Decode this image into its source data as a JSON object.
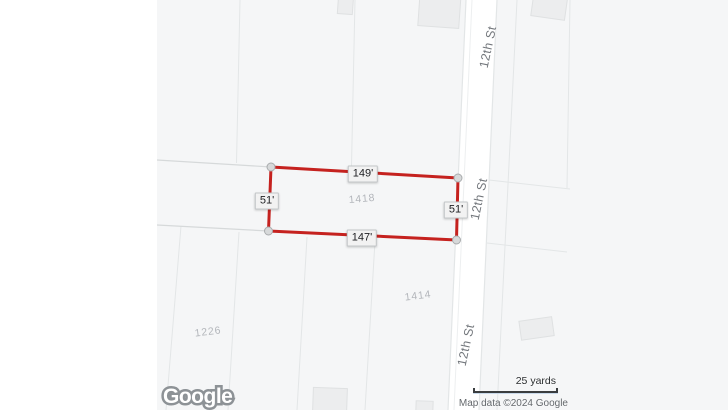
{
  "colors": {
    "land": "#f5f6f7",
    "road": "#ffffff",
    "line": "#e3e6e7",
    "boundary": "#d6d9da",
    "building": "#ecedee",
    "building_edge": "#dfe1e2",
    "outline_red": "#c5221f",
    "handle_fill": "#d7d9da",
    "handle_edge": "#a8abad",
    "label_text": "#202124",
    "label_bg": "#f2f2f2",
    "label_border": "#c3c6c8",
    "muted_text": "#b3b6bb",
    "street_text": "#73777c",
    "attr_text": "#64686c",
    "scale_text": "#2a2d2f",
    "logo_stroke": "#8d9296"
  },
  "map": {
    "street_label": "12th St",
    "measurements": {
      "top": "149'",
      "left": "51'",
      "right": "51'",
      "bottom": "147'"
    },
    "parcels": {
      "center": "1418",
      "south": "1414",
      "southwest": "1226"
    },
    "scale_label": "25 yards",
    "attribution": "Map data ©2024 Google",
    "logo_text": "Google"
  }
}
